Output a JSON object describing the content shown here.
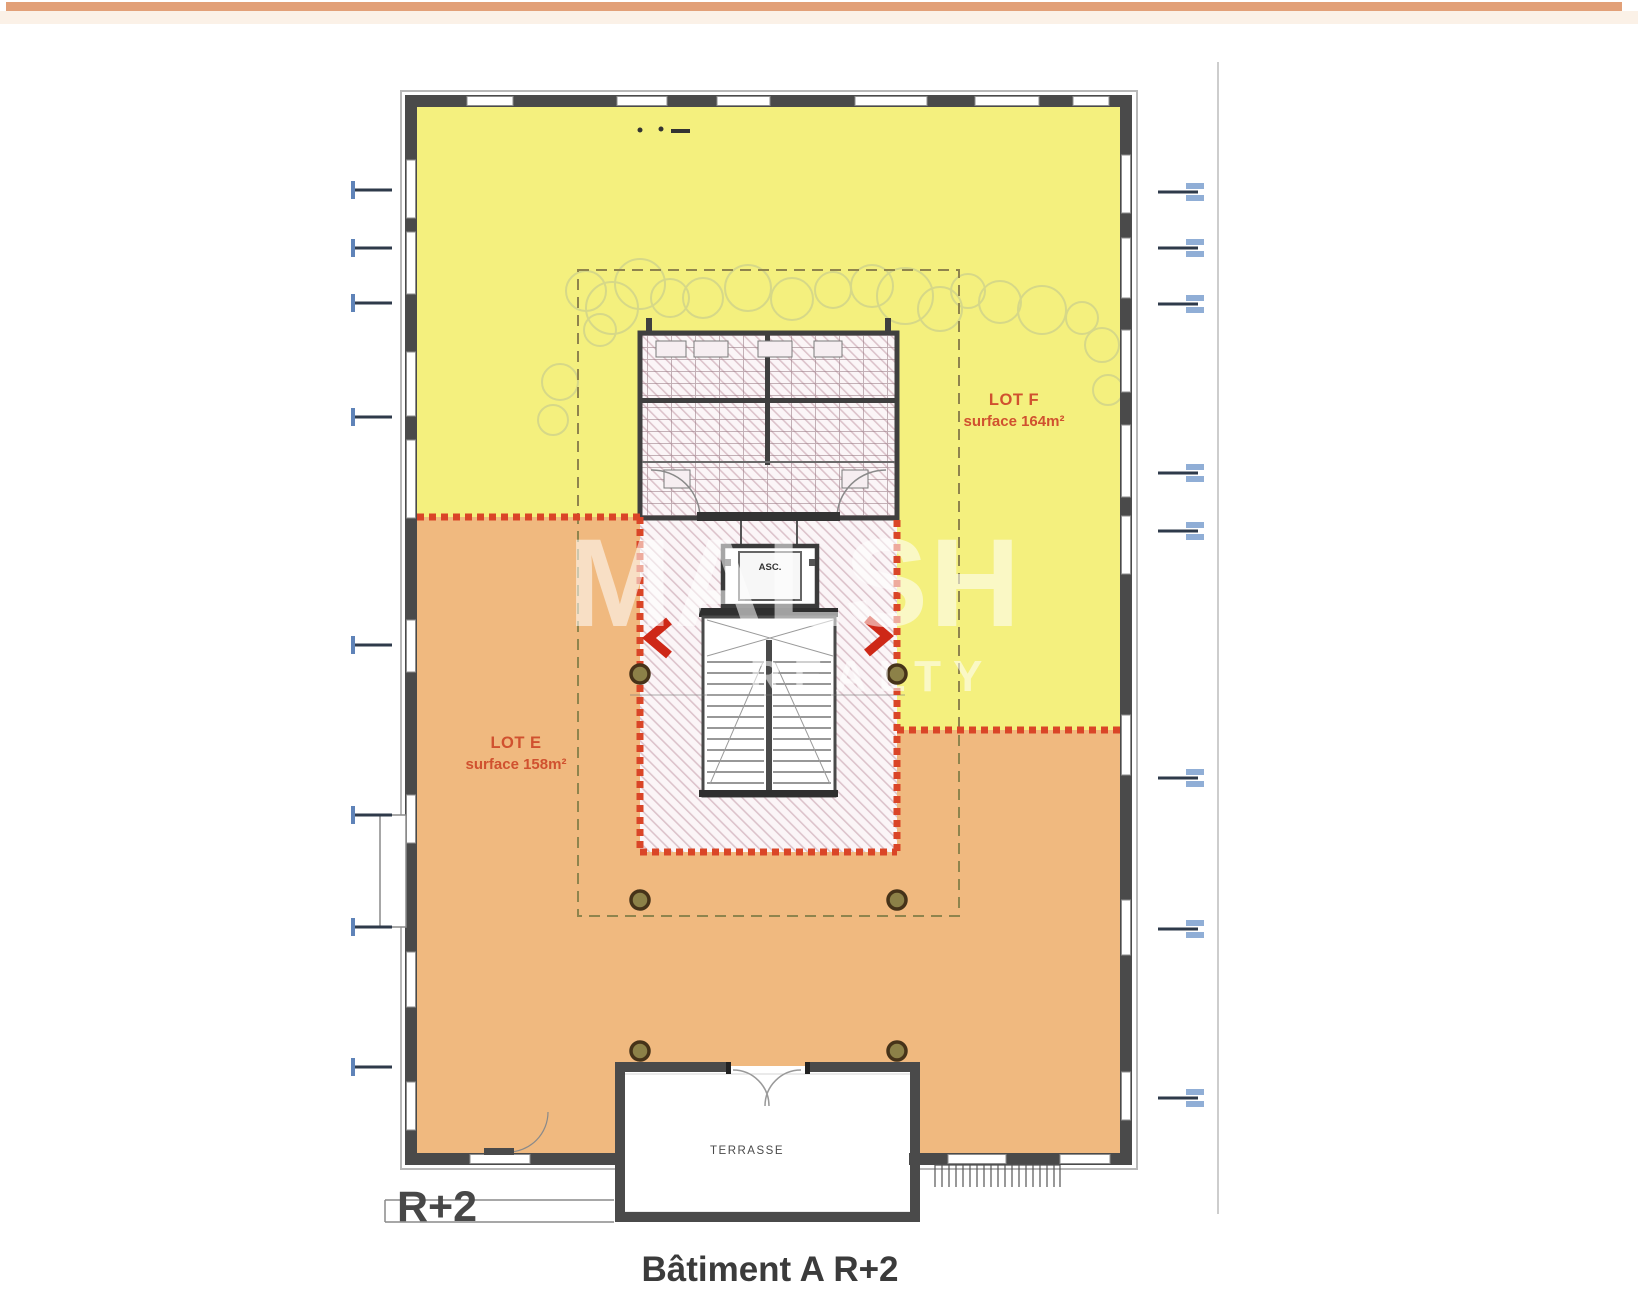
{
  "header": {
    "accent_bar_color": "#e2a078"
  },
  "watermark": {
    "line1": "MALSH",
    "line2": "REALTY"
  },
  "plan": {
    "caption": "Bâtiment A R+2",
    "level_label": "R+2",
    "terrace_label": "TERRASSE",
    "elevator_label": "ASC.",
    "lots": [
      {
        "name": "LOT F",
        "surface": "surface 164m²",
        "fill": "#f4f07e"
      },
      {
        "name": "LOT E",
        "surface": "surface 158m²",
        "fill": "#f0b97f"
      }
    ],
    "colors": {
      "lot_label_text": "#d0512f",
      "demising_dotted_line": "#da4527",
      "setback_dashed_line": "#8f844d",
      "walls": "#4a4a4a",
      "hatch_stripe": "#dcc3cb",
      "column_marker": "#8c8148",
      "dimension_marker_blue": "#5f83b8"
    }
  }
}
